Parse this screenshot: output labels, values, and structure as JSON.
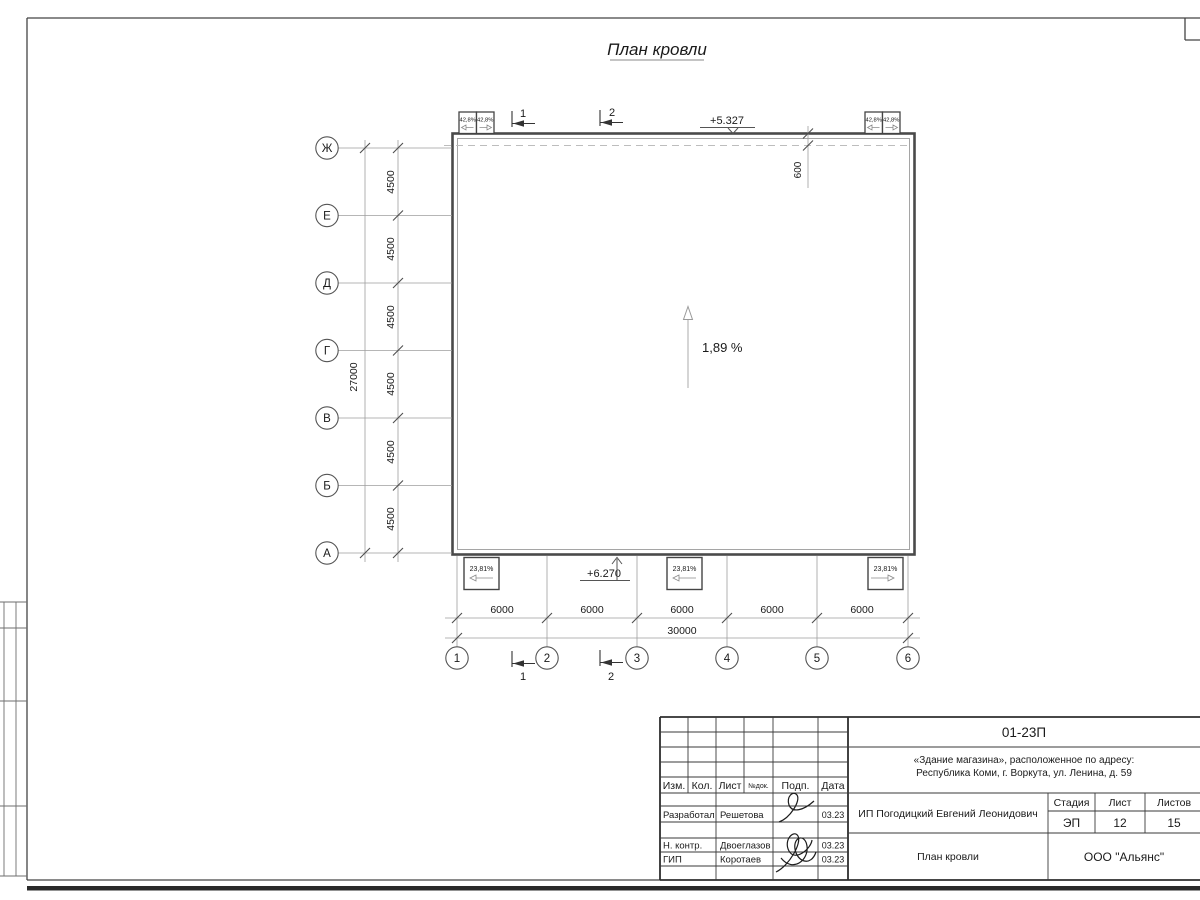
{
  "sheet": {
    "drawing_heading": "План кровли"
  },
  "drawing": {
    "left_axes": [
      "Ж",
      "Е",
      "Д",
      "Г",
      "В",
      "Б",
      "А"
    ],
    "left_dims": [
      "4500",
      "4500",
      "4500",
      "4500",
      "4500",
      "4500"
    ],
    "left_total": "27000",
    "bottom_axes": [
      "1",
      "2",
      "3",
      "4",
      "5",
      "6"
    ],
    "bottom_dims": [
      "6000",
      "6000",
      "6000",
      "6000",
      "6000"
    ],
    "bottom_total": "30000",
    "elevation_top": "+5.327",
    "elevation_bottom": "+6.270",
    "main_slope": "1,89 %",
    "parapet_slope": "42,8%",
    "eave_slope": "23,81%",
    "overhang_dim": "600",
    "section_marks": [
      "1",
      "2"
    ]
  },
  "titleblock": {
    "doc_number": "01-23П",
    "project_address_line1": "«Здание магазина», расположенное по адресу:",
    "project_address_line2": "Республика Коми, г. Воркута, ул. Ленина, д. 59",
    "client": "ИП Погодицкий Евгений Леонидович",
    "drawing_name": "План кровли",
    "company": "ООО \"Альянс\"",
    "columns": [
      "Изм.",
      "Кол.",
      "Лист",
      "№док.",
      "Подп.",
      "Дата"
    ],
    "stage_labels": [
      "Стадия",
      "Лист",
      "Листов"
    ],
    "stage_values": [
      "ЭП",
      "12",
      "15"
    ],
    "signature_rows": [
      {
        "role": "Разработал",
        "name": "Решетова",
        "date": "03.23"
      },
      {
        "role": "Н. контр.",
        "name": "Двоеглазов",
        "date": "03.23"
      },
      {
        "role": "ГИП",
        "name": "Коротаев",
        "date": "03.23"
      }
    ]
  },
  "colors": {
    "line_dark": "#4a4a4a",
    "line_mid": "#9a9a9a",
    "line_light": "#bdbdbd",
    "text": "#1a1a1a"
  }
}
